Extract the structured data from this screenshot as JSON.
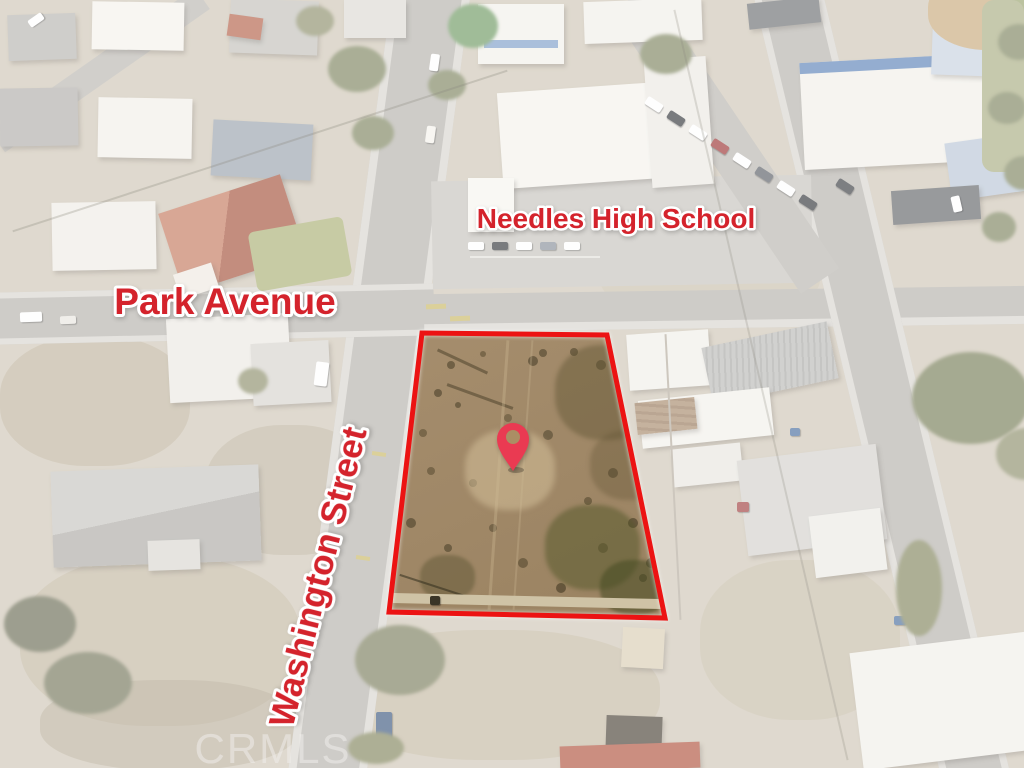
{
  "labels": {
    "school": "Needles High School",
    "park_avenue": "Park Avenue",
    "washington_street": "Washington Street"
  },
  "watermark": "CRMLS",
  "colors": {
    "annotation_red": "#d4232c",
    "annotation_stroke": "#ffffff",
    "parcel_outline": "#ec1313",
    "pin": "#ea3a52",
    "pin_hole": "#ab8e64",
    "watermark": "#f2f0ee"
  },
  "icons": {
    "location_pin": "teardrop-map-marker"
  }
}
